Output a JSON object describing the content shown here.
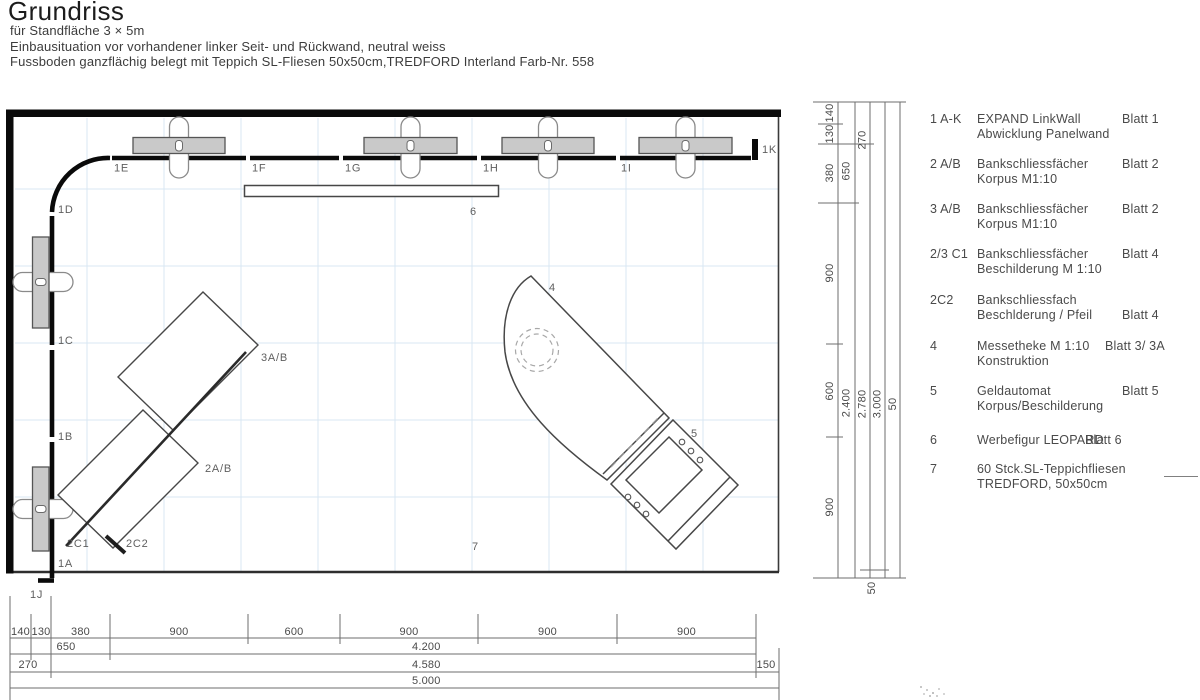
{
  "header": {
    "title": "Grundriss",
    "subtitle": [
      "für Standfläche 3 × 5m",
      "Einbausituation vor vorhandener linker Seit- und Rückwand, neutral weiss",
      "Fussboden ganzflächig belegt mit Teppich SL-Fliesen 50x50cm,TREDFORD Interland Farb-Nr. 558"
    ]
  },
  "plan": {
    "walls": {
      "e": "1E",
      "f": "1F",
      "g": "1G",
      "h": "1H",
      "i": "1I",
      "k": "1K",
      "d": "1D",
      "c": "1C",
      "b": "1B",
      "a": "1A",
      "j": "1J"
    },
    "items": {
      "theke": "4",
      "atm": "5",
      "leopard": "6",
      "teppich": "7",
      "korpus3": "3A/B",
      "korpus2": "2A/B",
      "c1": "2C1",
      "c2": "2C2"
    }
  },
  "dims_bottom": {
    "segments": [
      "140",
      "130",
      "380",
      "900",
      "600",
      "900",
      "900",
      "900"
    ],
    "row2": [
      "650",
      "4.200"
    ],
    "row3": [
      "270",
      "4.580",
      "150"
    ],
    "row4": [
      "5.000"
    ]
  },
  "dims_right": {
    "segments": [
      "140",
      "130",
      "380",
      "900",
      "600",
      "900"
    ],
    "totals": [
      "650",
      "2.400",
      "270",
      "2.780",
      "3.000",
      "3.050",
      "50"
    ]
  },
  "legend": {
    "rows": [
      {
        "code": "1 A-K",
        "line1": "EXPAND LinkWall",
        "line2": "Abwicklung Panelwand",
        "blatt": "Blatt 1"
      },
      {
        "code": "2 A/B",
        "line1": "Bankschliessfächer",
        "line2": "Korpus M1:10",
        "blatt": "Blatt 2"
      },
      {
        "code": "3 A/B",
        "line1": "Bankschliessfächer",
        "line2": "Korpus M1:10",
        "blatt": "Blatt 2"
      },
      {
        "code": "2/3 C1",
        "line1": "Bankschliessfächer",
        "line2": "Beschilderung M 1:10",
        "blatt": "Blatt 4"
      },
      {
        "code": "2C2",
        "line1": "Bankschliessfach",
        "line2": "Beschlderung / Pfeil",
        "blatt": "Blatt 4"
      },
      {
        "code": "4",
        "line1": "Messetheke M 1:10",
        "line2": "Konstruktion",
        "blatt": "Blatt 3/ 3A"
      },
      {
        "code": "5",
        "line1": "Geldautomat",
        "line2": "Korpus/Beschilderung",
        "blatt": "Blatt 5"
      },
      {
        "code": "6",
        "line1": "Werbefigur LEOPARD",
        "line2": "",
        "blatt": "Blatt 6"
      },
      {
        "code": "7",
        "line1": "60 Stck.SL-Teppichfliesen",
        "line2": "TREDFORD, 50x50cm",
        "blatt": ""
      }
    ]
  },
  "colors": {
    "wall": "#0a0a0a",
    "line": "#444444",
    "grid": "#d9e7f3",
    "locker_fill": "#c9c9c9",
    "locker_stroke": "#555555",
    "text": "#4a4a4a"
  }
}
